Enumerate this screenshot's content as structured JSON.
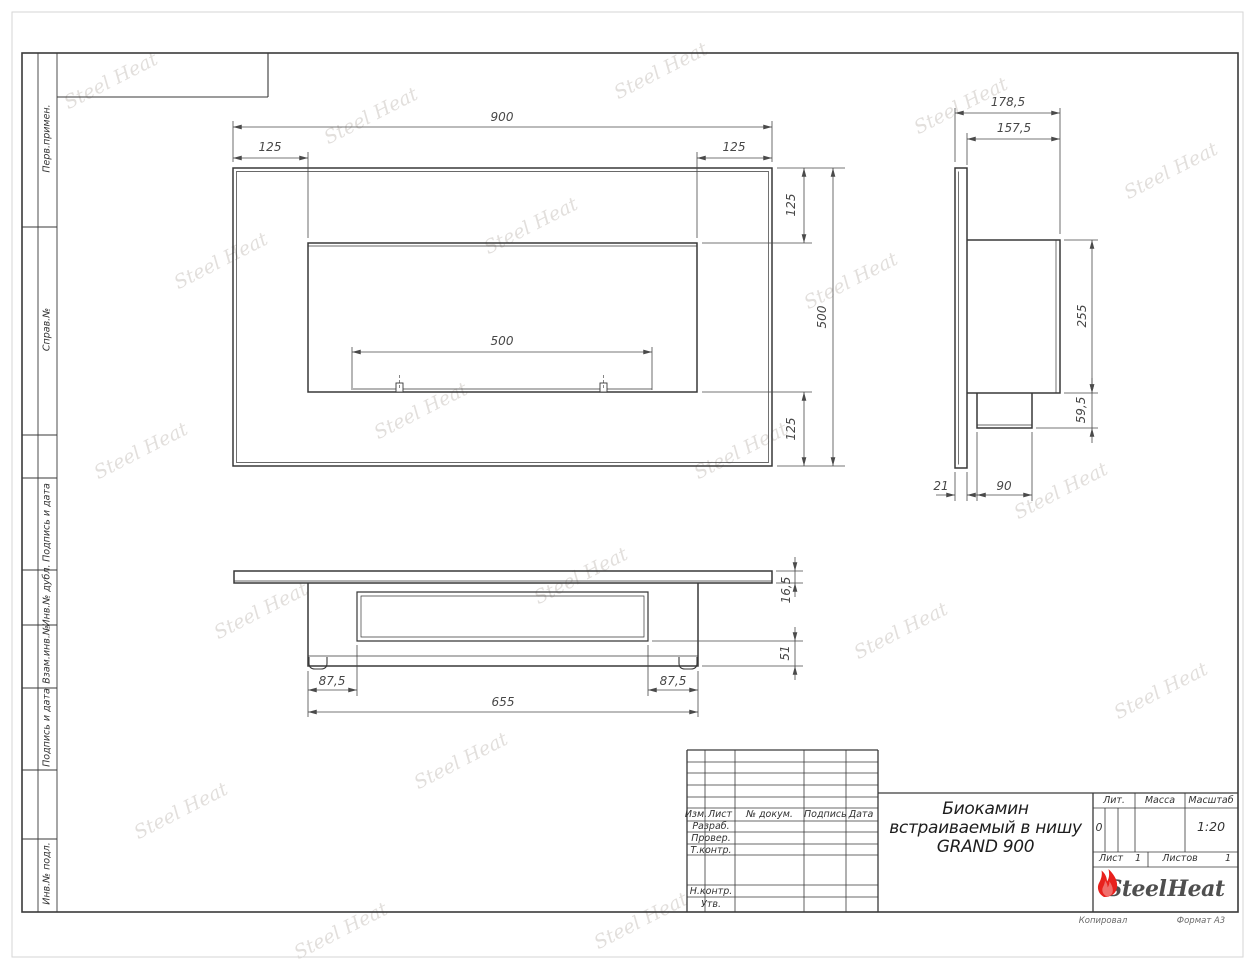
{
  "watermark": {
    "text": "Steel Heat"
  },
  "left_column": {
    "labels": [
      "Перв.примен.",
      "Справ.№",
      "Подпись и дата",
      "Инв.№ дубл.",
      "Взам.инв.№",
      "Подпись и дата",
      "Инв.№ подл."
    ]
  },
  "title_block": {
    "revision_header": [
      "Изм.",
      "Лист",
      "№ докум.",
      "Подпись",
      "Дата"
    ],
    "row_labels": [
      "Разраб.",
      "Провер.",
      "Т.контр.",
      "Н.контр.",
      "Утв."
    ],
    "title_lines": [
      "Биокамин",
      "встраиваемый в нишу",
      "GRAND 900"
    ],
    "lit_label": "Лит.",
    "lit_value": "0",
    "mass_label": "Масса",
    "scale_label": "Масштаб",
    "scale_value": "1:20",
    "sheet_label": "Лист",
    "sheet_value": "1",
    "sheets_label": "Листов",
    "sheets_value": "1",
    "logo_steel": "Steel",
    "logo_heat": "Heat"
  },
  "footer": {
    "copied": "Копировал",
    "format": "Формат А3"
  },
  "dims": {
    "front": {
      "width": "900",
      "offset_left": "125",
      "offset_right": "125",
      "offset_top": "125",
      "height": "500",
      "opening_width": "500",
      "offset_bottom": "125"
    },
    "side": {
      "total_depth": "178,5",
      "body_depth": "157,5",
      "body_height": "255",
      "box_height": "59,5",
      "panel_thickness": "21",
      "box_depth": "90"
    },
    "bottom": {
      "flange_thickness": "16,5",
      "base_height": "51",
      "offset_left": "87,5",
      "offset_right": "87,5",
      "body_width": "655"
    }
  }
}
